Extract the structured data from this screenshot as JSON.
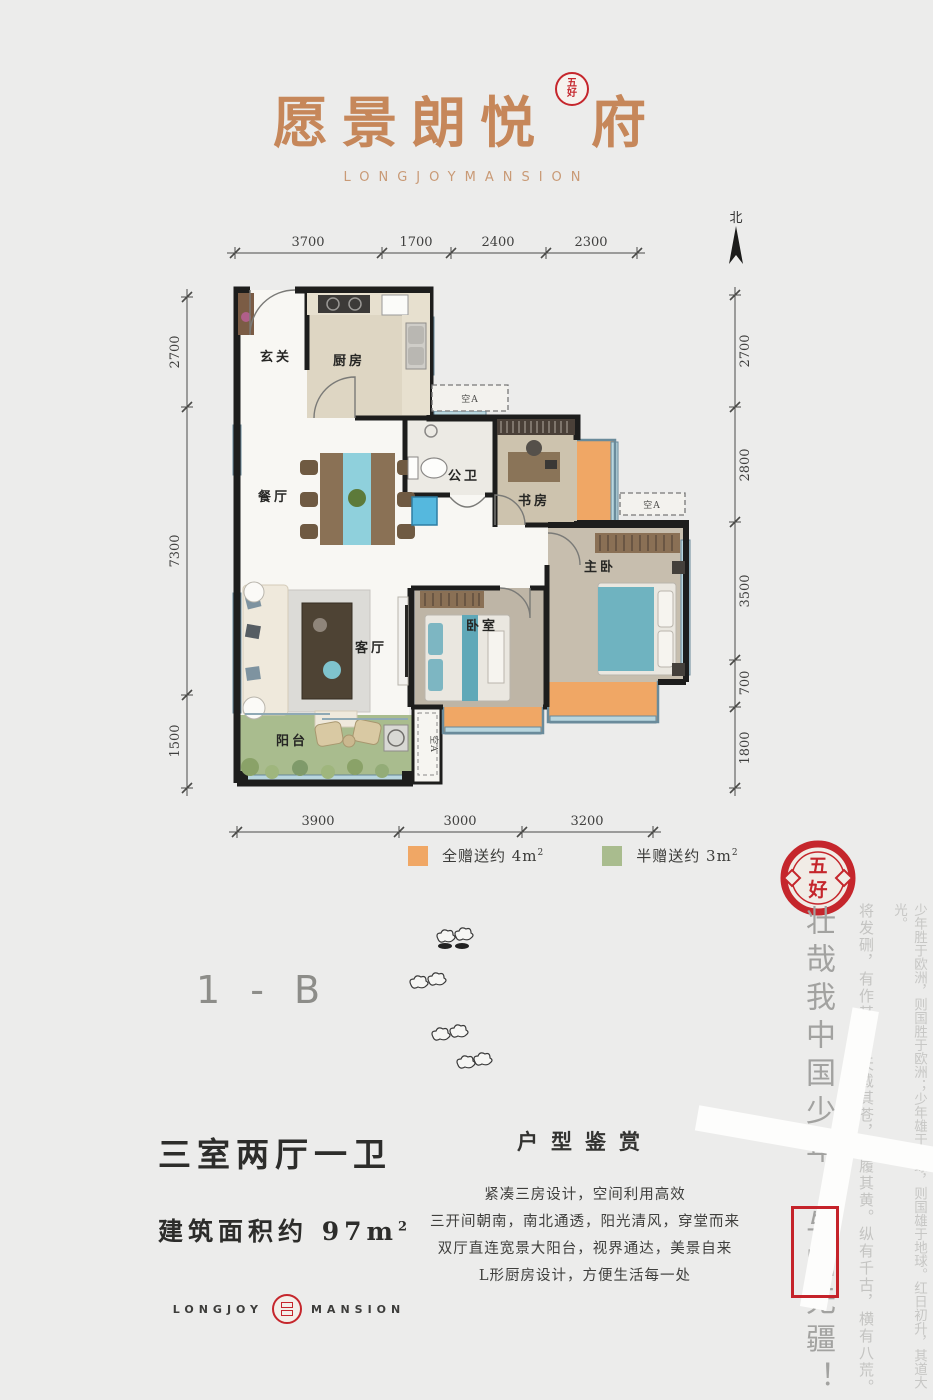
{
  "brand": {
    "title_pre": "愿景朗悦",
    "title_post": "府",
    "seal_top": "五",
    "seal_bottom": "好",
    "subtitle": "LONGJOYMANSION"
  },
  "compass": {
    "north_label": "北"
  },
  "plan": {
    "dims_top": [
      "3700",
      "1700",
      "2400",
      "2300"
    ],
    "dims_bottom": [
      "3900",
      "3000",
      "3200"
    ],
    "dims_left": [
      "2700",
      "7300",
      "1500"
    ],
    "dims_right": [
      "2700",
      "2800",
      "3500",
      "700",
      "1800"
    ],
    "rooms": {
      "entry": "玄关",
      "kitchen": "厨房",
      "dining": "餐厅",
      "bath": "公卫",
      "study": "书房",
      "master": "主卧",
      "bedroom": "卧室",
      "living": "客厅",
      "balcony": "阳台"
    },
    "ac_label": "空A",
    "colors": {
      "gift_full": "#f0a765",
      "gift_half": "#a9bc8e",
      "wall": "#1d1d1c",
      "window_glass": "#b9d6de",
      "accent_teal": "#6fb3c0",
      "seal_red": "#c5262c",
      "brand_tan": "#c6875a"
    },
    "legend": [
      {
        "text": "全赠送约 4m",
        "sup": "2",
        "color": "#f0a765"
      },
      {
        "text": "半赠送约 3m",
        "sup": "2",
        "color": "#a9bc8e"
      }
    ]
  },
  "unit_code": "1 - B",
  "summary": {
    "layout": "三室两厅一卫",
    "area_label": "建筑面积约 ",
    "area_value": "97m",
    "area_sup": "2",
    "logo_left": "LONGJOY",
    "logo_right": "MANSION"
  },
  "appreciation": {
    "title": "户型鉴赏",
    "lines": [
      "紧凑三房设计，空间利用高效",
      "三开间朝南，南北通透，阳光清风，穿堂而来",
      "双厅直连宽景大阳台，视界通达，美景自来",
      "L形厨房设计，方便生活每一处"
    ]
  },
  "poem": {
    "large_pre": "壮哉我中国少年，",
    "large_boxed": "与国",
    "large_post": "无疆！",
    "col_inner": "将发硎，有作其芒。天戴其苍，地履其黄。纵有千古，横有八荒。",
    "col_outer": "少年胜于欧洲，则国胜于欧洲；少年雄于地球，则国雄于地球。红日初升，其道大光。",
    "watermark": "十",
    "seal_top": "五",
    "seal_bottom": "好"
  }
}
